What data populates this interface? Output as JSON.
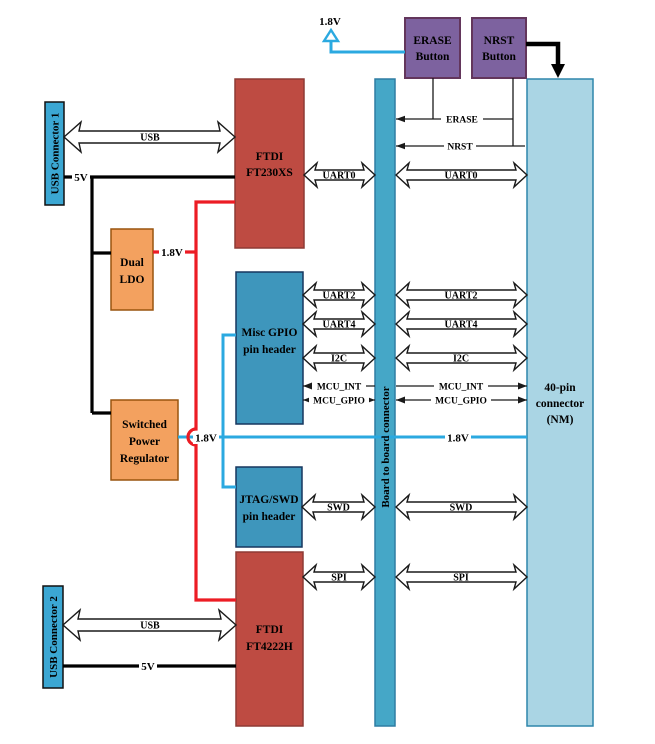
{
  "diagram": {
    "title_note": "board interconnect block diagram",
    "blocks": {
      "usb_connector_1": {
        "label": "USB Connector 1"
      },
      "usb_connector_2": {
        "label": "USB Connector 2"
      },
      "dual_ldo": {
        "lines": [
          "Dual",
          "LDO"
        ]
      },
      "switched_power_regulator": {
        "lines": [
          "Switched",
          "Power",
          "Regulator"
        ]
      },
      "ftdi_ft230xs": {
        "lines": [
          "FTDI",
          "FT230XS"
        ]
      },
      "ftdi_ft4222h": {
        "lines": [
          "FTDI",
          "FT4222H"
        ]
      },
      "misc_gpio_header": {
        "lines": [
          "Misc GPIO",
          "pin header"
        ]
      },
      "jtag_swd_header": {
        "lines": [
          "JTAG/SWD",
          "pin header"
        ]
      },
      "erase_button": {
        "lines": [
          "ERASE",
          "Button"
        ]
      },
      "nrst_button": {
        "lines": [
          "NRST",
          "Button"
        ]
      },
      "board_to_board": {
        "label": "Board to board connector"
      },
      "pin40_connector": {
        "lines": [
          "40-pin",
          "connector",
          "(NM)"
        ]
      }
    },
    "buses": {
      "usb": "USB",
      "uart0": "UART0",
      "uart2": "UART2",
      "uart4": "UART4",
      "i2c": "I2C",
      "swd": "SWD",
      "spi": "SPI"
    },
    "signals": {
      "erase": "ERASE",
      "nrst": "NRST",
      "mcu_int": "MCU_INT",
      "mcu_gpio": "MCU_GPIO"
    },
    "power": {
      "v18_flag_top": "1.8V",
      "v18_ldo": "1.8V",
      "v18_regulator": "1.8V",
      "v18_bus": "1.8V",
      "v5_top": "5V",
      "v5_bottom": "5V"
    },
    "colors": {
      "usb_connector_fill": "#3BA7D3",
      "pin_header_fill": "#3E96BC",
      "board_bar_fill": "#45A7C7",
      "pin40_fill": "#AAD5E4",
      "ftdi_fill": "#BE4B42",
      "orange_fill": "#F3A15F",
      "purple_fill": "#7D629F",
      "wire_red": "#EC1C24",
      "wire_cyan": "#2BA9E0",
      "wire_black": "#000000"
    }
  }
}
